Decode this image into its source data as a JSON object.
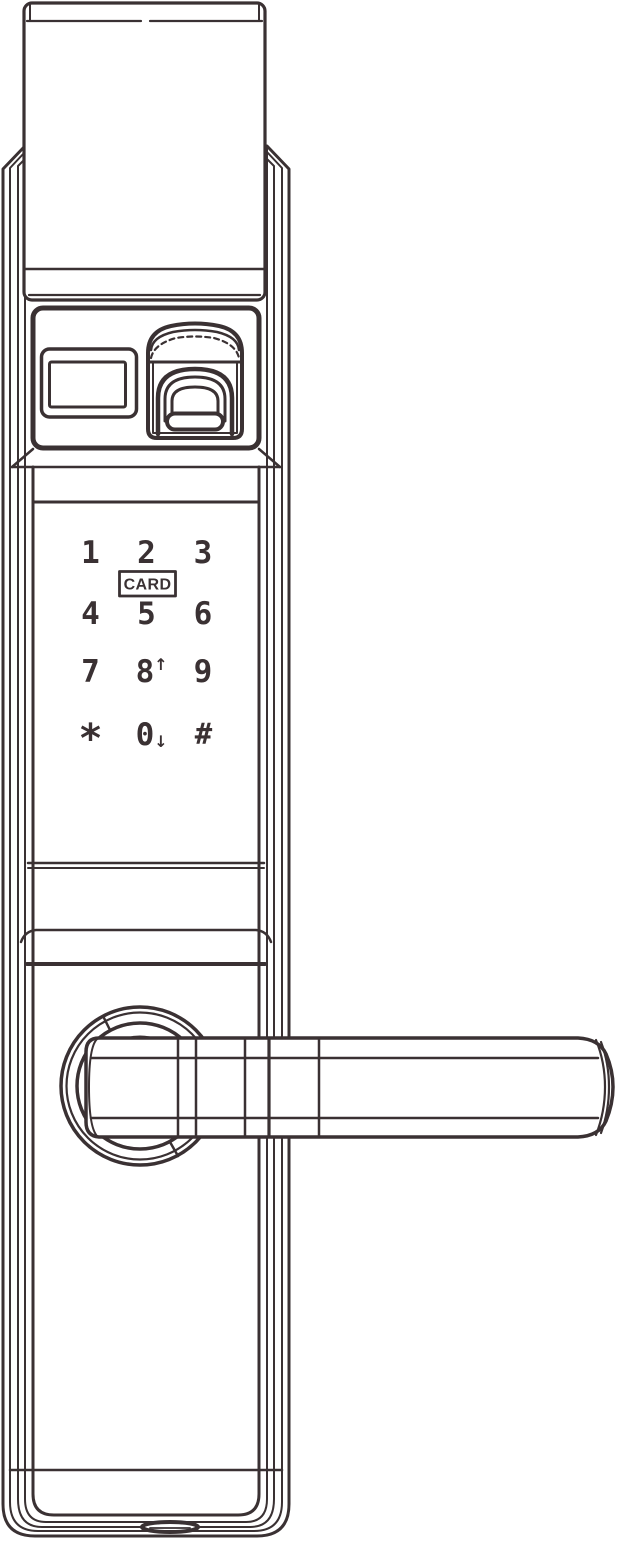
{
  "device": {
    "colors": {
      "line": "#3a3133",
      "background": "#ffffff"
    },
    "icons": [
      "fingerprint-scanner-icon",
      "scroll-up-icon",
      "scroll-down-icon",
      "usb-port-icon"
    ]
  },
  "keypad": {
    "card_label": "CARD",
    "arrow_up": "↑",
    "arrow_down": "↓",
    "keys": [
      {
        "label": "1"
      },
      {
        "label": "2"
      },
      {
        "label": "3"
      },
      {
        "label": "4"
      },
      {
        "label": "5"
      },
      {
        "label": "6"
      },
      {
        "label": "7"
      },
      {
        "label": "8"
      },
      {
        "label": "9"
      },
      {
        "label": "*"
      },
      {
        "label": "0"
      },
      {
        "label": "#"
      }
    ]
  }
}
